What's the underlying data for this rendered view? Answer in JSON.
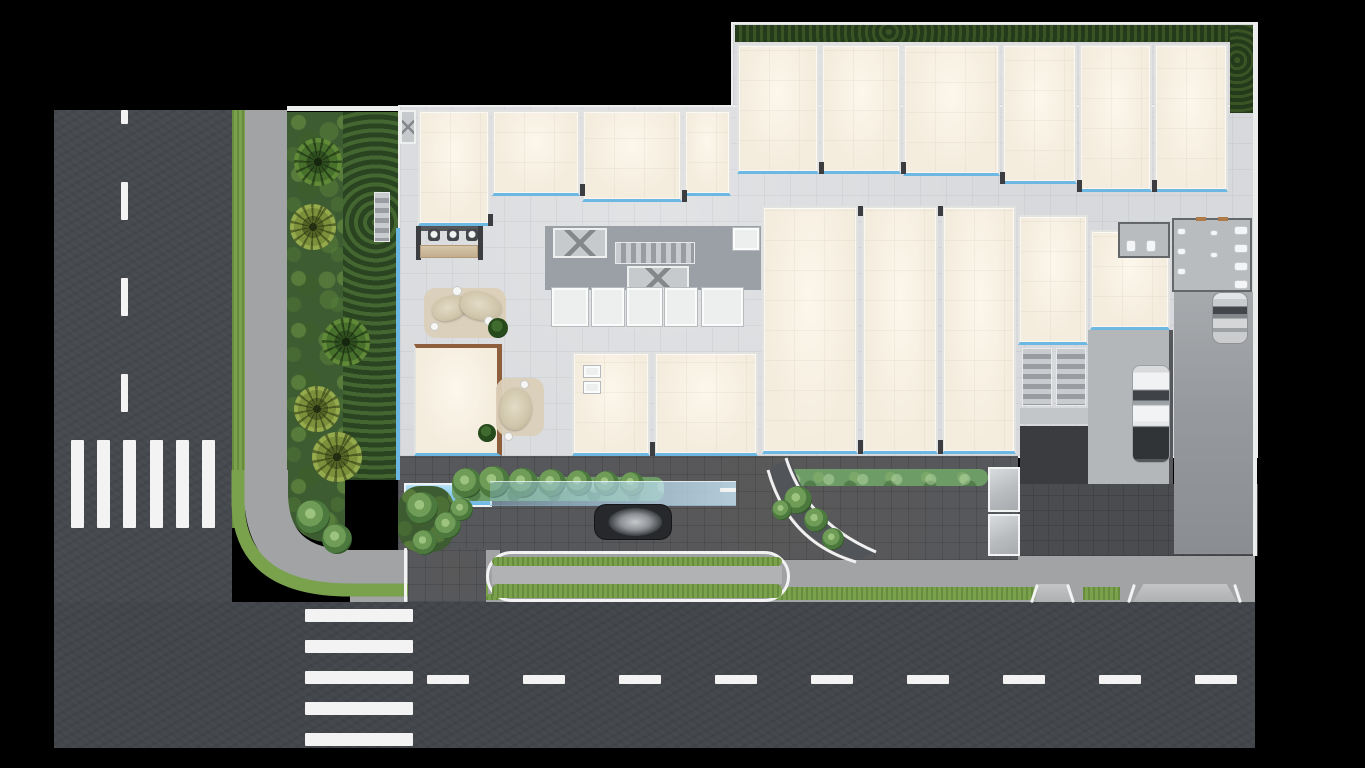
{
  "meta": {
    "title": "Ground-floor architectural site plan — top-down render",
    "visible_text": "none"
  },
  "palette": {
    "asphalt": "#46494e",
    "asphalt2": "#43464b",
    "roadline": "#f3f3f3",
    "grass": "#7aa24d",
    "hedgedark": "#2c4420",
    "hedgemid": "#6d9c66",
    "sidewalk": "#a1a3a5",
    "paverlight": "#d7d9dc",
    "paverdark": "#56585c",
    "roofcream": "#f4ecdd",
    "glassblue": "#6cb8e2",
    "poolblue": "#6fb8e4",
    "wood": "#8e5f3d",
    "cardark": "#26282b",
    "carwhite": "#eef0f1",
    "carsilver": "#bfc2c5",
    "background": "#000000"
  },
  "counts": {
    "crosswalk_left_bars": 6,
    "crosswalk_bottom_bars": 5,
    "bottom_lane_dashes": 9,
    "left_lane_dashes": 4,
    "top_right_units": 6,
    "top_left_units": 4,
    "center_units": 3,
    "lower_units": 2,
    "palm_trees": 5,
    "vehicles": 3
  },
  "layers": {
    "l1": [
      [
        "road-left",
        "asphalt",
        54,
        110,
        178,
        638
      ],
      [
        "road-bottom",
        "asphalt2",
        54,
        602,
        1201,
        146
      ],
      [
        "center-dash-left-1",
        "mark",
        121,
        110,
        7,
        14
      ],
      [
        "center-dash-left-2",
        "mark",
        121,
        182,
        7,
        38
      ],
      [
        "center-dash-left-3",
        "mark",
        121,
        278,
        7,
        38
      ],
      [
        "center-dash-left-4",
        "mark",
        121,
        374,
        7,
        38
      ],
      [
        "crosswalk-left-bar-1",
        "mark",
        71,
        440,
        13,
        88
      ],
      [
        "crosswalk-left-bar-2",
        "mark",
        97,
        440,
        13,
        88
      ],
      [
        "crosswalk-left-bar-3",
        "mark",
        123,
        440,
        13,
        88
      ],
      [
        "crosswalk-left-bar-4",
        "mark",
        150,
        440,
        13,
        88
      ],
      [
        "crosswalk-left-bar-5",
        "mark",
        176,
        440,
        13,
        88
      ],
      [
        "crosswalk-left-bar-6",
        "mark",
        202,
        440,
        13,
        88
      ],
      [
        "crosswalk-bottom-bar-1",
        "mark",
        305,
        609,
        108,
        13
      ],
      [
        "crosswalk-bottom-bar-2",
        "mark",
        305,
        640,
        108,
        13
      ],
      [
        "crosswalk-bottom-bar-3",
        "mark",
        305,
        671,
        108,
        13
      ],
      [
        "crosswalk-bottom-bar-4",
        "mark",
        305,
        702,
        108,
        13
      ],
      [
        "crosswalk-bottom-bar-5",
        "mark",
        305,
        733,
        108,
        13
      ],
      [
        "center-dash-bottom-1",
        "mark",
        427,
        675,
        42,
        9
      ],
      [
        "center-dash-bottom-2",
        "mark",
        523,
        675,
        42,
        9
      ],
      [
        "center-dash-bottom-3",
        "mark",
        619,
        675,
        42,
        9
      ],
      [
        "center-dash-bottom-4",
        "mark",
        715,
        675,
        42,
        9
      ],
      [
        "center-dash-bottom-5",
        "mark",
        811,
        675,
        42,
        9
      ],
      [
        "center-dash-bottom-6",
        "mark",
        907,
        675,
        42,
        9
      ],
      [
        "center-dash-bottom-7",
        "mark",
        1003,
        675,
        42,
        9
      ],
      [
        "center-dash-bottom-8",
        "mark",
        1099,
        675,
        42,
        9
      ],
      [
        "center-dash-bottom-9",
        "mark",
        1195,
        675,
        42,
        9
      ],
      [
        "verge-grass-left",
        "grass-strip",
        232,
        110,
        13,
        418
      ],
      [
        "sidewalk-left",
        "sidewalk",
        245,
        110,
        42,
        400
      ],
      [
        "sidewalk-bottom",
        "sidewalk",
        350,
        556,
        905,
        46
      ],
      [
        "grass-strip-bottom-1",
        "grass-strip",
        486,
        587,
        549,
        13
      ],
      [
        "grass-strip-bottom-2",
        "grass-strip",
        1083,
        587,
        37,
        13
      ]
    ],
    "l2": [
      [
        "planting-bed-outer",
        "shrub-bed",
        287,
        112,
        58,
        430,
        "0 0 40px 90px"
      ],
      [
        "planting-bed-inner",
        "hedge-dark2",
        343,
        112,
        55,
        368
      ],
      [
        "property-wall-top",
        "wall-white",
        287,
        106,
        444,
        5
      ],
      [
        "garden-stair",
        "stairs-v",
        374,
        192,
        16,
        50
      ],
      [
        "slab-main",
        "slab",
        398,
        105,
        860,
        353
      ],
      [
        "slab-top",
        "slab",
        731,
        22,
        527,
        85
      ],
      [
        "terrace-pavers",
        "paver-dark",
        398,
        456,
        620,
        104
      ],
      [
        "court-pavers-right",
        "paver-dark3",
        1018,
        484,
        240,
        72
      ],
      [
        "parking-apron",
        "paver-mid",
        1088,
        330,
        84,
        154
      ],
      [
        "parking-lane",
        "lane",
        1174,
        292,
        80,
        262
      ],
      [
        "apron-wall",
        "wall-dark",
        1169,
        330,
        4,
        154
      ],
      [
        "perimeter-hedge-top",
        "hedge-dark",
        735,
        25,
        513,
        17
      ],
      [
        "perimeter-hedge-right",
        "hedge-dark",
        1230,
        25,
        24,
        88
      ],
      [
        "perimeter-wall-right",
        "wall-white",
        1253,
        22,
        4,
        534
      ],
      [
        "glass-wall-left",
        "glassline",
        396,
        228,
        4,
        252
      ],
      [
        "unit-t1",
        "unit",
        737,
        44,
        82,
        130
      ],
      [
        "unit-t2",
        "unit",
        821,
        44,
        80,
        130
      ],
      [
        "unit-t3",
        "unit",
        903,
        44,
        97,
        132
      ],
      [
        "unit-t4",
        "unit",
        1002,
        44,
        75,
        140
      ],
      [
        "unit-t5",
        "unit",
        1079,
        44,
        73,
        148
      ],
      [
        "unit-t6",
        "unit",
        1154,
        44,
        74,
        148
      ],
      [
        "entry-vestibule",
        "elev",
        400,
        110,
        16,
        34
      ],
      [
        "unit-l1",
        "unit",
        418,
        110,
        72,
        116
      ],
      [
        "unit-l2",
        "unit",
        492,
        110,
        88,
        86
      ],
      [
        "unit-l3",
        "unit",
        582,
        110,
        100,
        92
      ],
      [
        "unit-l4",
        "unit",
        684,
        110,
        47,
        86
      ],
      [
        "unit-m1",
        "unit",
        762,
        206,
        96,
        248
      ],
      [
        "unit-m2",
        "unit",
        862,
        206,
        76,
        248
      ],
      [
        "unit-m3",
        "unit",
        942,
        206,
        74,
        248
      ],
      [
        "unit-b1",
        "unit",
        572,
        352,
        78,
        104
      ],
      [
        "unit-b2",
        "unit",
        654,
        352,
        104,
        104
      ],
      [
        "unit-r1",
        "unit",
        1018,
        215,
        70,
        130
      ],
      [
        "unit-r2",
        "unit",
        1090,
        230,
        80,
        100
      ],
      [
        "pavilion",
        "unit-wood",
        414,
        344,
        88,
        112
      ],
      [
        "core-corridor",
        "core-dark",
        545,
        226,
        216,
        64
      ],
      [
        "elevator-1",
        "elev",
        553,
        228,
        54,
        30
      ],
      [
        "core-stairs",
        "stairs-h",
        615,
        242,
        80,
        22
      ],
      [
        "elevator-2",
        "elev",
        627,
        266,
        62,
        24
      ],
      [
        "storage-1",
        "room-white",
        552,
        288,
        36,
        38
      ],
      [
        "storage-2",
        "room-white",
        592,
        288,
        32,
        38
      ],
      [
        "storage-3",
        "room-white",
        627,
        288,
        35,
        38
      ],
      [
        "storage-4",
        "room-white",
        665,
        288,
        32,
        38
      ],
      [
        "storage-5",
        "room-white",
        702,
        288,
        41,
        38
      ],
      [
        "room-right",
        "room-white",
        733,
        228,
        26,
        22
      ],
      [
        "bar-wall-left",
        "jamb",
        416,
        226,
        5,
        34
      ],
      [
        "bar-wall-right",
        "jamb",
        478,
        226,
        5,
        34
      ],
      [
        "bar-back-wall",
        "wall-dark",
        421,
        226,
        57,
        5
      ],
      [
        "bar-stool-1",
        "stool",
        428,
        229,
        12,
        12
      ],
      [
        "bar-stool-2",
        "stool",
        447,
        229,
        12,
        12
      ],
      [
        "bar-stool-3",
        "stool",
        466,
        229,
        12,
        12
      ],
      [
        "bar-counter",
        "counter",
        420,
        245,
        58,
        13
      ],
      [
        "lounge-rug",
        "rug",
        424,
        288,
        82,
        50
      ],
      [
        "lounge-sofa-1",
        "sofa",
        432,
        296,
        36,
        24,
        null,
        -18
      ],
      [
        "lounge-sofa-2",
        "sofa",
        460,
        292,
        42,
        28,
        null,
        12
      ],
      [
        "side-table-1",
        "dot",
        452,
        286,
        10,
        10
      ],
      [
        "side-table-2",
        "dot",
        484,
        316,
        10,
        10
      ],
      [
        "side-table-3",
        "dot",
        430,
        322,
        9,
        9
      ],
      [
        "lounge-plant",
        "plant",
        488,
        318,
        20,
        20
      ],
      [
        "pavilion-rug",
        "rug",
        496,
        378,
        48,
        58
      ],
      [
        "pavilion-sofa",
        "sofa",
        500,
        388,
        32,
        42,
        null,
        8
      ],
      [
        "pavilion-table-1",
        "dot",
        520,
        380,
        9,
        9
      ],
      [
        "pavilion-table-2",
        "dot",
        504,
        432,
        9,
        9
      ],
      [
        "pavilion-plant",
        "plant",
        478,
        424,
        18,
        18
      ],
      [
        "cafe-table-1",
        "room-white",
        584,
        366,
        16,
        11
      ],
      [
        "cafe-table-2",
        "room-white",
        584,
        382,
        16,
        11
      ],
      [
        "restroom-a",
        "rest",
        1118,
        222,
        52,
        36
      ],
      [
        "toilet-a1",
        "fixture",
        1126,
        240,
        10,
        12
      ],
      [
        "toilet-a2",
        "fixture",
        1146,
        240,
        10,
        12
      ],
      [
        "restroom-b",
        "rest",
        1172,
        218,
        80,
        74
      ],
      [
        "sink-b1",
        "fixture",
        1177,
        228,
        9,
        7
      ],
      [
        "sink-b2",
        "fixture",
        1177,
        248,
        9,
        7
      ],
      [
        "sink-b3",
        "fixture",
        1177,
        268,
        9,
        7
      ],
      [
        "urinal-b1",
        "fixture",
        1210,
        230,
        8,
        6
      ],
      [
        "urinal-b2",
        "fixture",
        1210,
        252,
        8,
        6
      ],
      [
        "toilet-b1",
        "fixture",
        1234,
        226,
        14,
        9
      ],
      [
        "toilet-b2",
        "fixture",
        1234,
        244,
        14,
        9
      ],
      [
        "toilet-b3",
        "fixture",
        1234,
        262,
        14,
        9
      ],
      [
        "toilet-b4",
        "fixture",
        1234,
        280,
        14,
        9
      ],
      [
        "door-mark-1",
        "wood-mark",
        1196,
        217,
        10,
        4
      ],
      [
        "door-mark-2",
        "wood-mark",
        1218,
        217,
        10,
        4
      ],
      [
        "stair-right-1",
        "stairs-v",
        1022,
        348,
        30,
        58
      ],
      [
        "stair-right-2",
        "stairs-v",
        1056,
        348,
        30,
        58
      ],
      [
        "stair-landing",
        "core-light",
        1020,
        408,
        68,
        16
      ],
      [
        "pit-floor",
        "floor-dark",
        1020,
        426,
        68,
        58
      ],
      [
        "pool",
        "pool",
        404,
        483,
        88,
        24
      ],
      [
        "pool-hedge",
        "hedge-mid",
        452,
        477,
        212,
        24
      ],
      [
        "pool-tree-1",
        "tree",
        452,
        468,
        30,
        30
      ],
      [
        "pool-tree-2",
        "tree",
        478,
        466,
        32,
        32
      ],
      [
        "pool-tree-3",
        "tree",
        508,
        468,
        30,
        30
      ],
      [
        "pool-tree-4",
        "tree",
        538,
        469,
        28,
        28
      ],
      [
        "pool-tree-5",
        "tree",
        566,
        470,
        26,
        26
      ],
      [
        "pool-tree-6",
        "tree",
        594,
        471,
        25,
        25
      ],
      [
        "pool-tree-7",
        "tree",
        620,
        472,
        24,
        24
      ],
      [
        "canopy-walkway",
        "canopy",
        490,
        481,
        246,
        25
      ],
      [
        "canopy-tip",
        "mark",
        720,
        488,
        16,
        4
      ],
      [
        "hedge-dropoff-right",
        "hedge-mid",
        788,
        469,
        200,
        17
      ],
      [
        "jamb-t1",
        "jamb",
        819,
        162,
        5,
        12
      ],
      [
        "jamb-t2",
        "jamb",
        901,
        162,
        5,
        12
      ],
      [
        "jamb-t3",
        "jamb",
        1000,
        172,
        5,
        12
      ],
      [
        "jamb-t4",
        "jamb",
        1077,
        180,
        5,
        12
      ],
      [
        "jamb-t5",
        "jamb",
        1152,
        180,
        5,
        12
      ],
      [
        "jamb-l1",
        "jamb",
        488,
        214,
        5,
        12
      ],
      [
        "jamb-l2",
        "jamb",
        580,
        184,
        5,
        12
      ],
      [
        "jamb-l3",
        "jamb",
        682,
        190,
        5,
        12
      ],
      [
        "jamb-m1",
        "jamb",
        858,
        206,
        5,
        10
      ],
      [
        "jamb-m2",
        "jamb",
        938,
        206,
        5,
        10
      ],
      [
        "jamb-m3",
        "jamb",
        858,
        440,
        5,
        14
      ],
      [
        "jamb-m4",
        "jamb",
        938,
        440,
        5,
        14
      ],
      [
        "jamb-b1",
        "jamb",
        650,
        442,
        5,
        14
      ]
    ],
    "l3": [
      [
        "entry-drive",
        "paver-dark",
        408,
        548,
        78,
        54
      ],
      [
        "entry-curb",
        "mark",
        404,
        548,
        3,
        54
      ],
      [
        "island-outer",
        "island",
        486,
        551,
        304,
        51
      ],
      [
        "island-grass-top",
        "grass-strip",
        492,
        557,
        290,
        9,
        6
      ],
      [
        "island-walk",
        "sidewalk2",
        492,
        566,
        290,
        18
      ],
      [
        "island-grass-bottom",
        "grass-strip",
        492,
        584,
        290,
        14,
        6
      ],
      [
        "ramp-1",
        "ramp",
        1035,
        584,
        36,
        18
      ],
      [
        "ramp-2",
        "ramp",
        1133,
        584,
        104,
        18
      ],
      [
        "ramp-edge-1",
        "mark",
        1033,
        584,
        3,
        19,
        null,
        18
      ],
      [
        "ramp-edge-2",
        "mark",
        1069,
        584,
        3,
        19,
        null,
        -18
      ],
      [
        "ramp-edge-3",
        "mark",
        1130,
        584,
        3,
        19,
        null,
        18
      ],
      [
        "ramp-edge-4",
        "mark",
        1236,
        584,
        3,
        19,
        null,
        -18
      ],
      [
        "exit-tree-1",
        "tree",
        784,
        486,
        28,
        28
      ],
      [
        "exit-tree-2",
        "tree",
        804,
        508,
        24,
        24
      ],
      [
        "exit-tree-3",
        "tree",
        822,
        528,
        22,
        22
      ],
      [
        "exit-tree-4",
        "tree",
        772,
        500,
        20,
        20
      ],
      [
        "entry-shrub",
        "shrub-bed",
        398,
        486,
        56,
        66,
        22
      ],
      [
        "entry-tree-1",
        "tree",
        406,
        492,
        32,
        32
      ],
      [
        "entry-tree-2",
        "tree",
        434,
        512,
        27,
        27
      ],
      [
        "entry-tree-3",
        "tree",
        412,
        530,
        25,
        25
      ],
      [
        "entry-tree-4",
        "tree",
        450,
        498,
        23,
        23
      ],
      [
        "bed-tree-1",
        "tree",
        296,
        500,
        34,
        34
      ],
      [
        "bed-tree-2",
        "tree",
        322,
        524,
        30,
        30
      ],
      [
        "palm-1",
        "palm-a",
        294,
        138,
        48,
        48
      ],
      [
        "palm-2",
        "palm-b",
        290,
        204,
        46,
        46
      ],
      [
        "palm-3",
        "palm-a",
        322,
        318,
        48,
        48
      ],
      [
        "palm-4",
        "palm-b",
        294,
        386,
        46,
        46
      ],
      [
        "palm-5",
        "palm-b",
        312,
        432,
        50,
        50
      ],
      [
        "glass-canopy-1",
        "glass",
        988,
        467,
        32,
        45
      ],
      [
        "glass-canopy-2",
        "glass",
        988,
        514,
        32,
        42
      ],
      [
        "car-sedan",
        "car-dark",
        594,
        504,
        78,
        36,
        12
      ],
      [
        "car-pickup",
        "car-truck",
        1133,
        366,
        36,
        96,
        7
      ],
      [
        "car-compact",
        "car-silver",
        1213,
        293,
        34,
        50,
        8
      ]
    ]
  }
}
